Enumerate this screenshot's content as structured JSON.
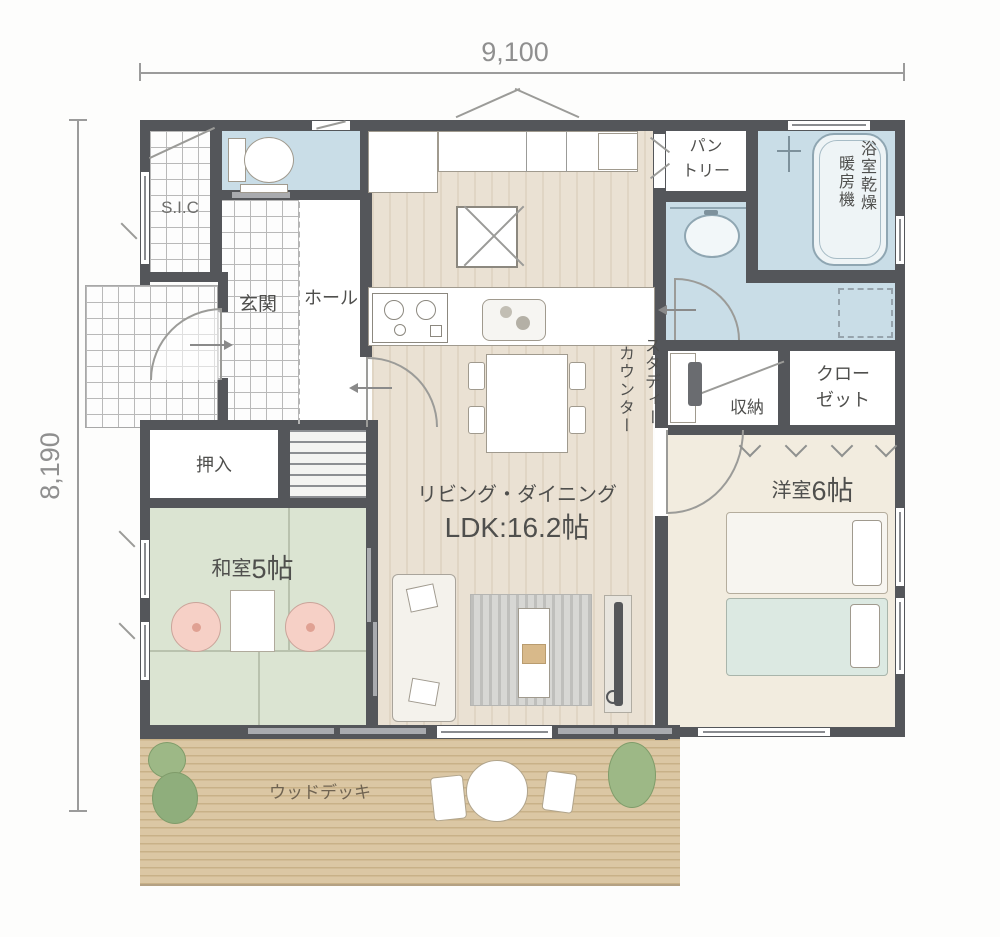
{
  "dimensions": {
    "width_label": "9,100",
    "height_label": "8,190"
  },
  "rooms": {
    "sic": {
      "label": "S.I.C"
    },
    "toilet": {
      "label": ""
    },
    "genkan": {
      "label": "玄関"
    },
    "hall": {
      "label": "ホール"
    },
    "pantry": {
      "line1": "パン",
      "line2": "トリー"
    },
    "bath": {
      "vertical_line1": "浴室乾燥",
      "vertical_line2": "暖房機"
    },
    "oshiire": {
      "label": "押入"
    },
    "washitsu": {
      "prefix": "和室",
      "size": "5帖"
    },
    "ldk": {
      "line1": "リビング・ダイニング",
      "line2": "LDK:16.2帖"
    },
    "study_counter": {
      "vertical_line1": "スタディー",
      "vertical_line2": "カウンター"
    },
    "storage": {
      "label": "収納"
    },
    "closet": {
      "line1": "クロー",
      "line2": "ゼット"
    },
    "youshitsu": {
      "prefix": "洋室",
      "size": "6帖"
    },
    "wood_deck": {
      "label": "ウッドデッキ"
    }
  },
  "colors": {
    "wall": "#54565a",
    "wet_area_floor": "#c9dde7",
    "ldk_floor": "#eae1d3",
    "tatami_floor": "#dbe4d2",
    "bedroom_floor": "#f2ecdf",
    "deck_floor": "#dbc7a4",
    "cushion_pink": "#f6d0c6",
    "bed_teal": "#dcе9e2",
    "dimension_text": "#8f8f8f"
  }
}
